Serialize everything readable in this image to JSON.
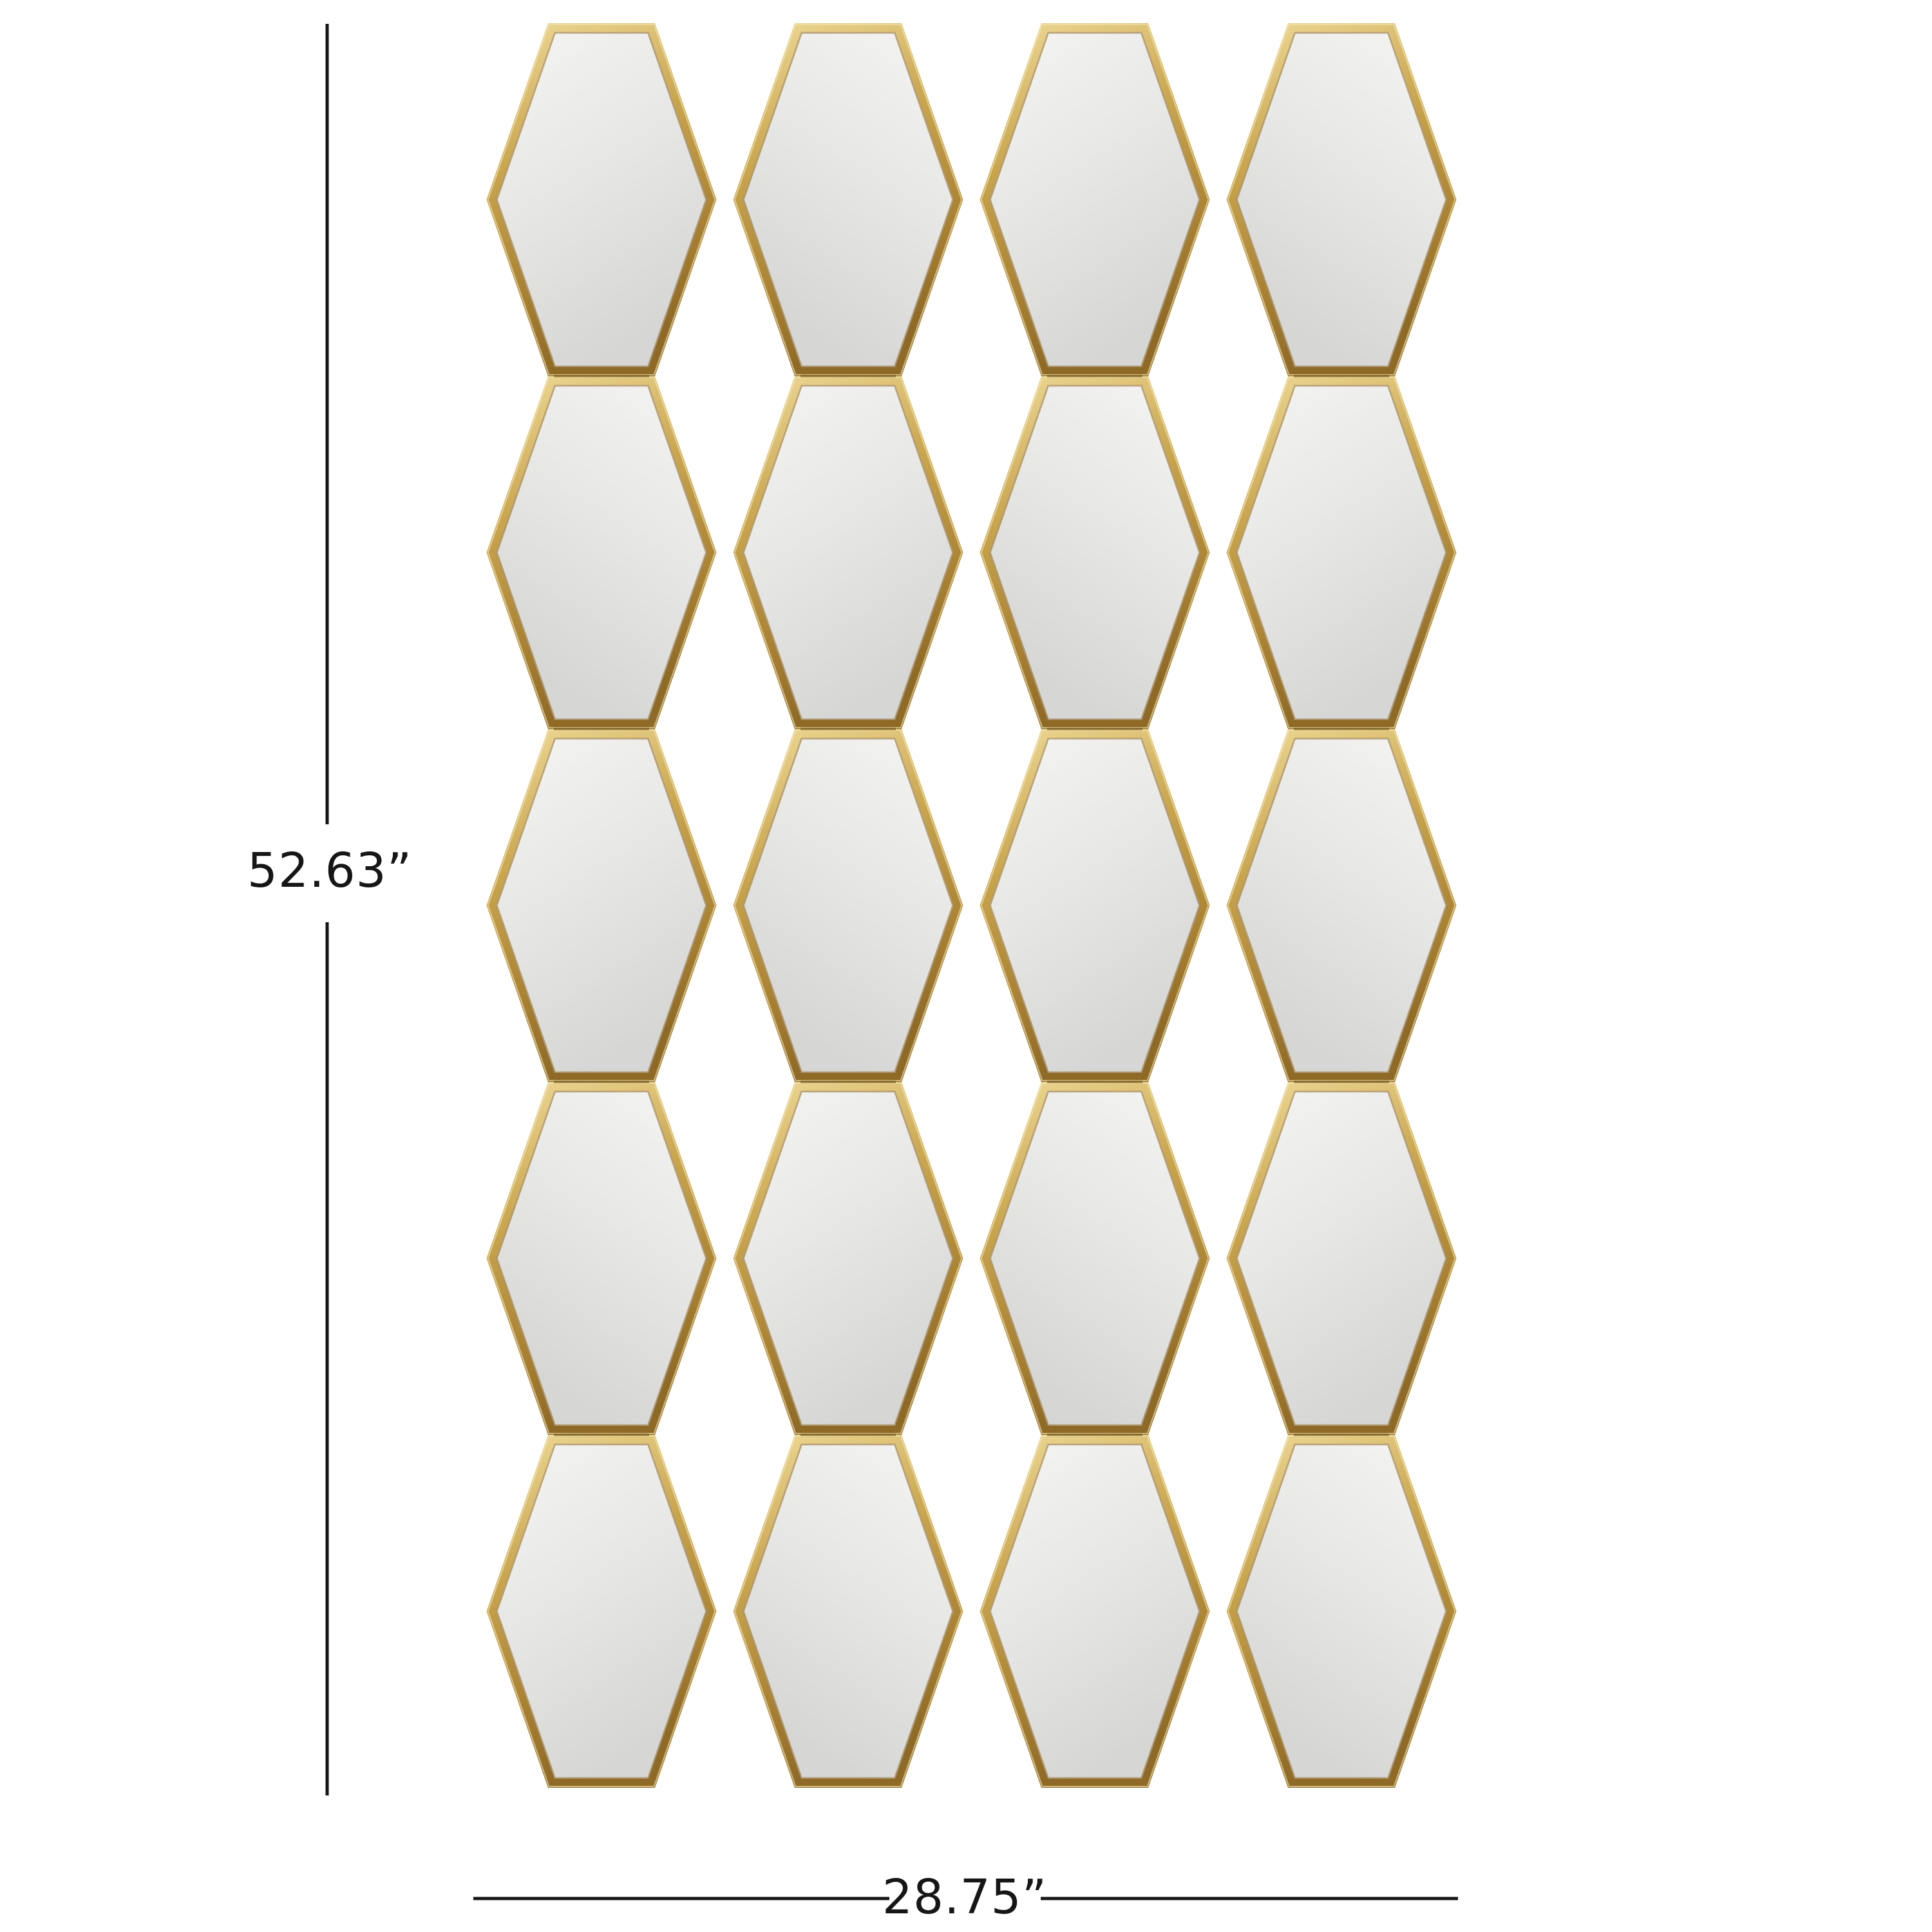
{
  "figure": {
    "description": "Gold honeycomb wall mirror panel made of 20 hexagonal mirror tiles arranged in 4 columns and 5 rows, shown on a white background with overall height and width dimension lines"
  },
  "dimensions": {
    "height_label": "52.63”",
    "width_label": "28.75”"
  },
  "grid": {
    "rows": 5,
    "columns": 4,
    "tile_shape": "hexagon",
    "tile_count": 20
  },
  "colors": {
    "background": "#ffffff",
    "frame_gold_light": "#eed996",
    "frame_gold": "#c9a54e",
    "frame_gold_dark": "#aa8233",
    "frame_gold_deep": "#8f6a26",
    "frame_lip": "#8a6522",
    "frame_highlight": "#f2e3ae",
    "frame_seam": "#6f5319",
    "mirror_light": "#f5f5f3",
    "mirror_mid": "#e7e7e5",
    "mirror_dark": "#d6d6d4",
    "dimension_line": "#161616",
    "dimension_text": "#161616"
  }
}
